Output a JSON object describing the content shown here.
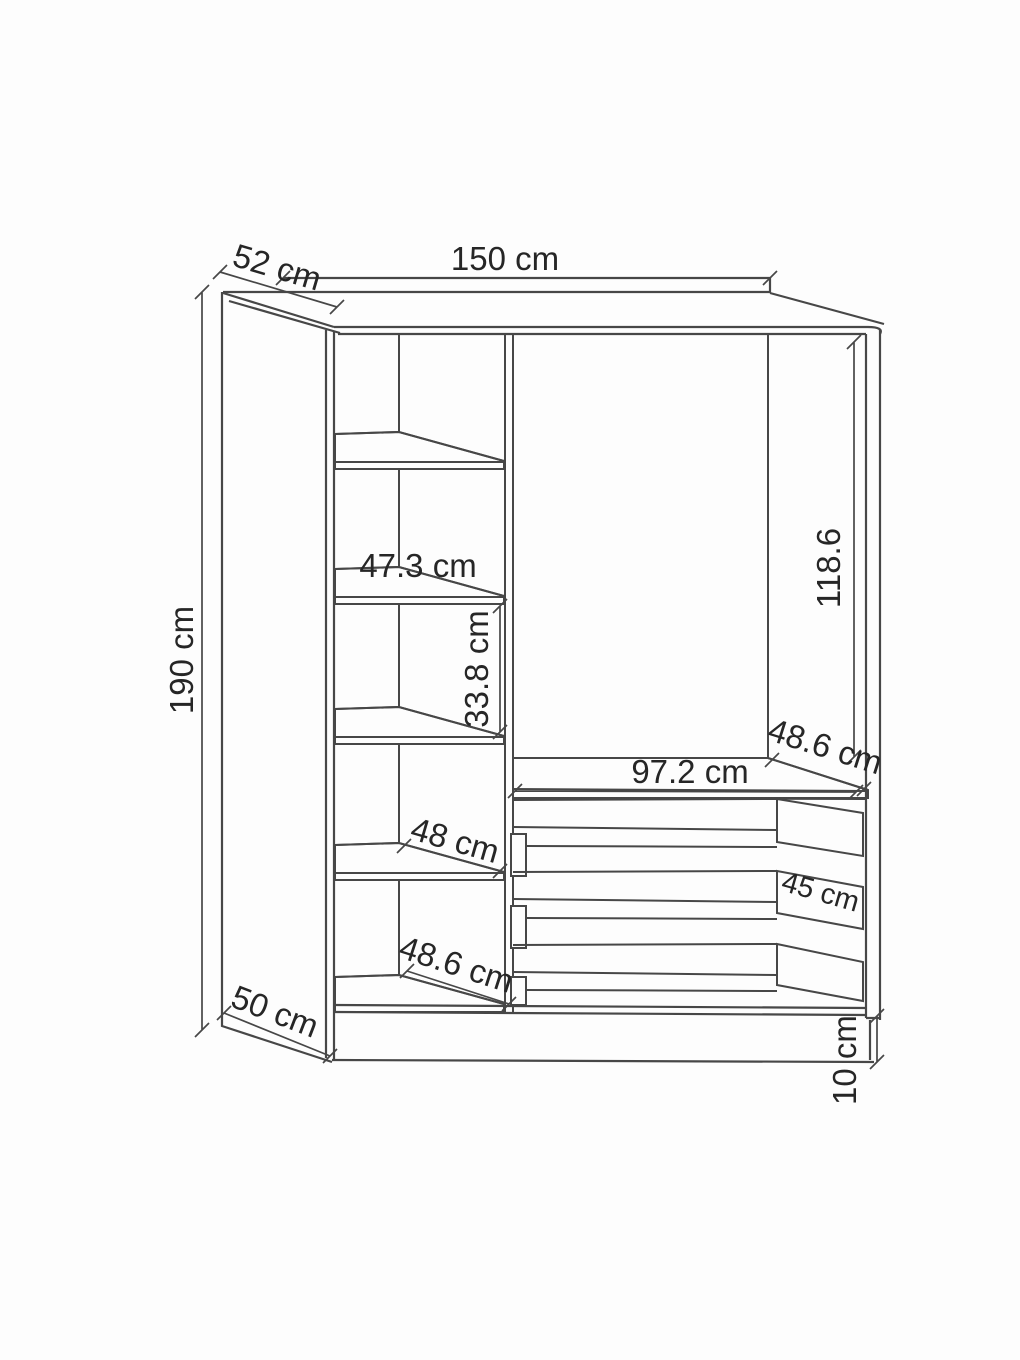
{
  "labels": {
    "overall_width": "150 cm",
    "top_depth": "52 cm",
    "overall_height": "190 cm",
    "upper_shelf_width": "47.3 cm",
    "shelf_spacing": "33.8 cm",
    "right_section_height": "118.6",
    "right_section_depth": "48.6 cm",
    "drawer_section_width": "97.2 cm",
    "lower_shelf_width": "48 cm",
    "drawer_depth": "45 cm",
    "bottom_shelf_width": "48.6 cm",
    "base_depth": "50 cm",
    "plinth_height": "10 cm"
  },
  "colors": {
    "background": "#fdfdfd",
    "line": "#474747",
    "dimension_text": "#262626"
  }
}
